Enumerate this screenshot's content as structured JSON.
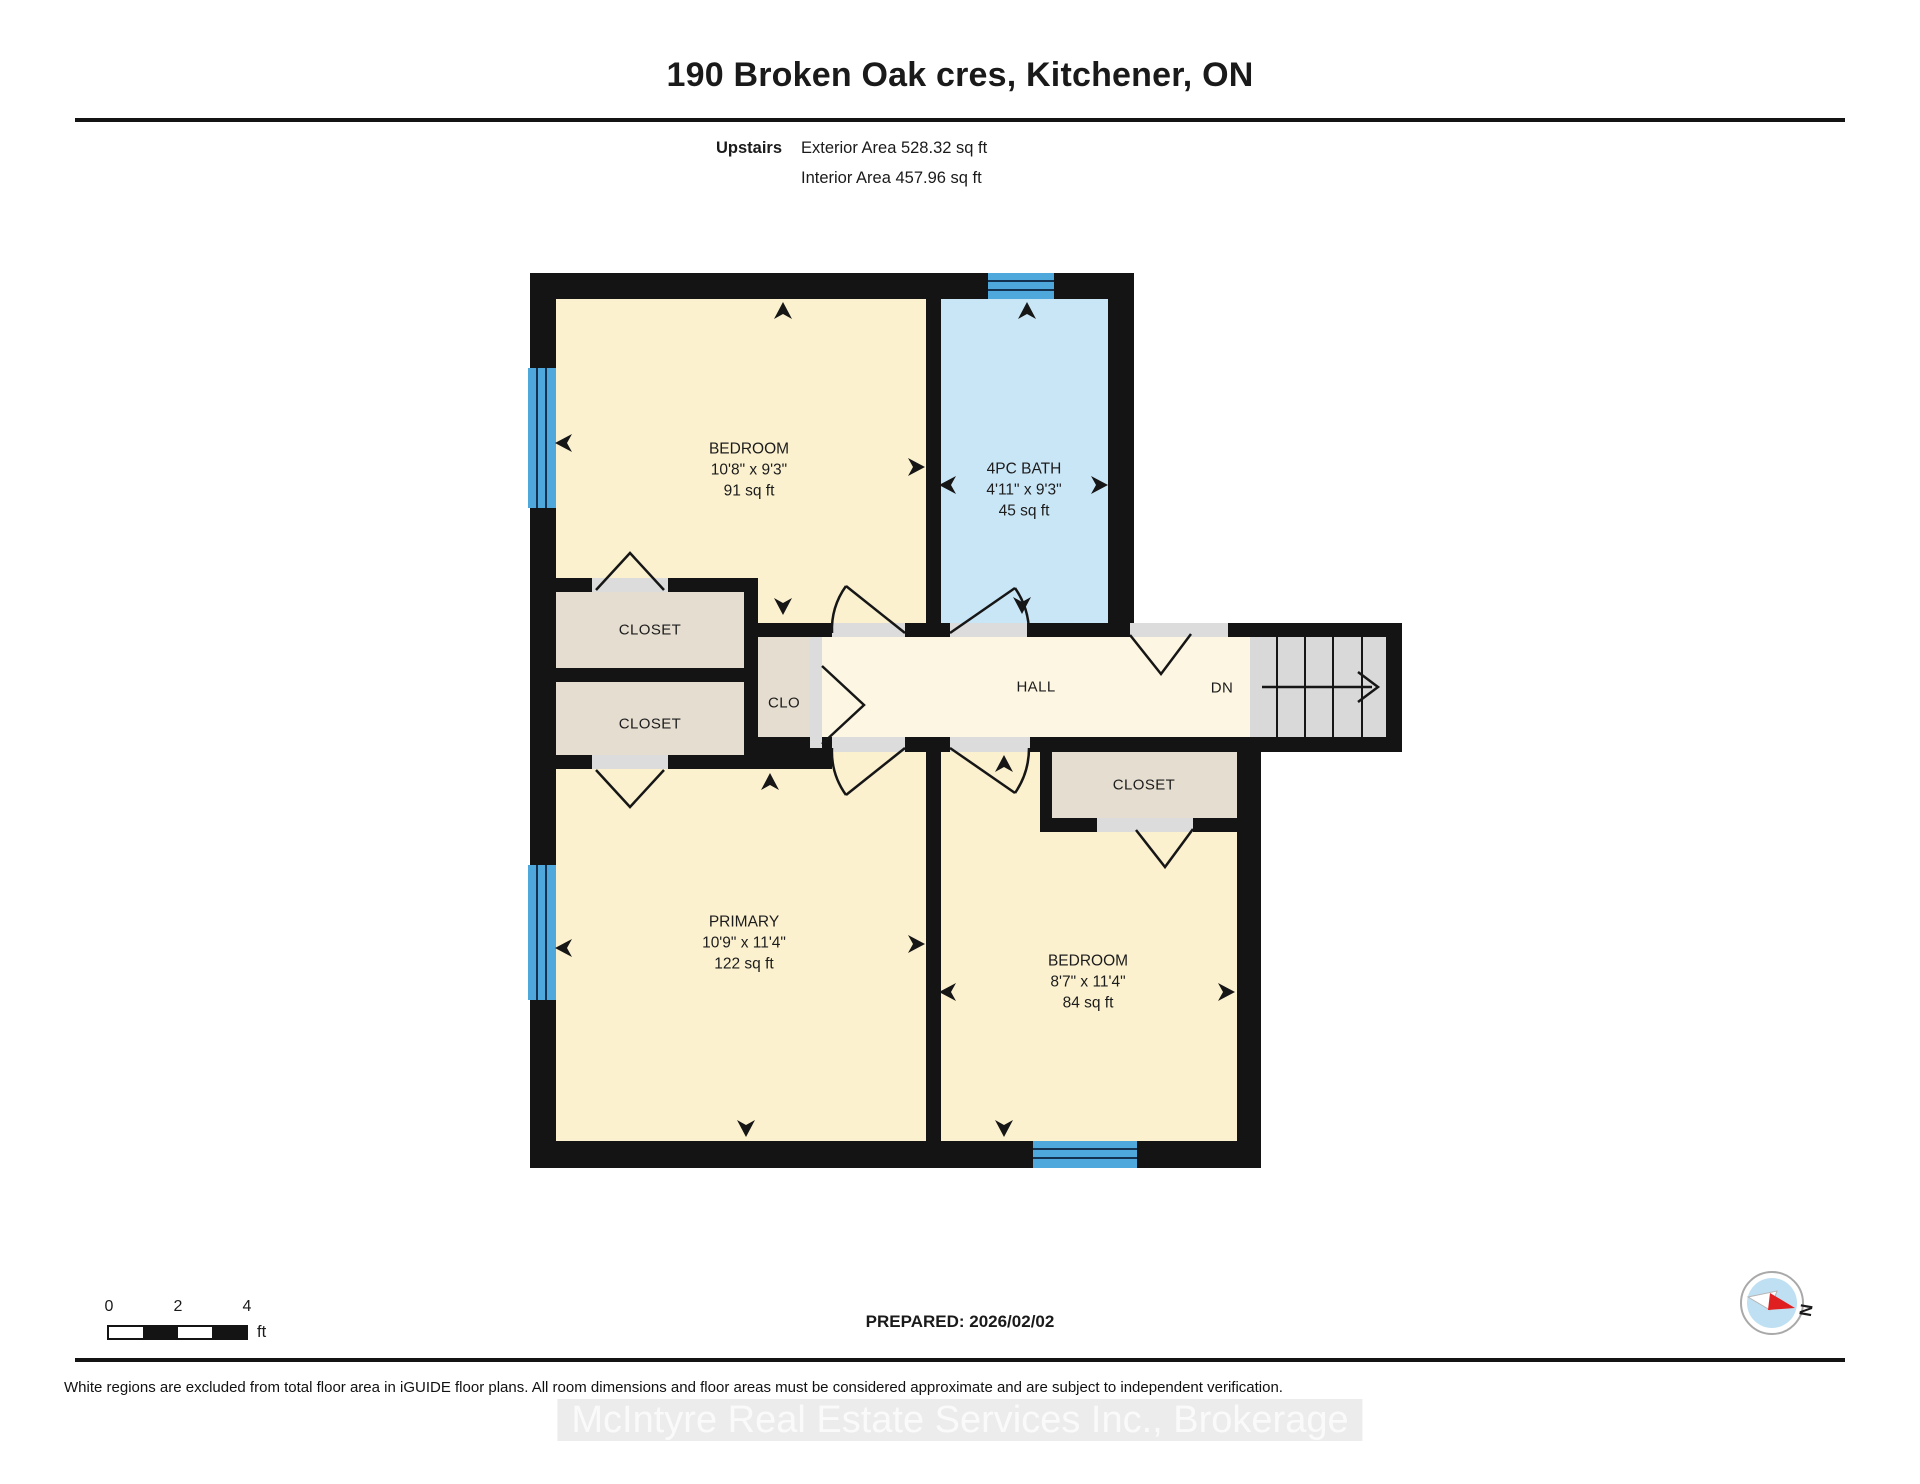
{
  "header": {
    "title": "190 Broken Oak cres, Kitchener, ON",
    "floor_label": "Upstairs",
    "exterior_area": "Exterior Area 528.32 sq ft",
    "interior_area": "Interior Area 457.96 sq ft"
  },
  "rooms": {
    "bedroom1": {
      "name": "BEDROOM",
      "dims": "10'8\" x 9'3\"",
      "area": "91 sq ft"
    },
    "bath": {
      "name": "4PC BATH",
      "dims": "4'11\" x 9'3\"",
      "area": "45 sq ft"
    },
    "closet_upper": {
      "name": "CLOSET"
    },
    "closet_lower": {
      "name": "CLOSET"
    },
    "clo": {
      "name": "CLO"
    },
    "hall": {
      "name": "HALL"
    },
    "stairs": {
      "dn_label": "DN"
    },
    "closet_bedroom2": {
      "name": "CLOSET"
    },
    "primary": {
      "name": "PRIMARY",
      "dims": "10'9\" x 11'4\"",
      "area": "122 sq ft"
    },
    "bedroom2": {
      "name": "BEDROOM",
      "dims": "8'7\" x 11'4\"",
      "area": "84 sq ft"
    }
  },
  "scale_bar": {
    "tick_0": "0",
    "tick_2": "2",
    "tick_4": "4",
    "unit": "ft"
  },
  "footer": {
    "prepared": "PREPARED: 2026/02/02",
    "compass_label": "N",
    "disclaimer": "White regions are excluded from total floor area in iGUIDE floor plans. All room dimensions and floor areas must be considered approximate and are subject to independent verification.",
    "watermark": "McIntyre Real Estate Services Inc., Brokerage"
  },
  "colors": {
    "wall": "#141414",
    "room_fill": "#FBF1CF",
    "hall_fill": "#FDF6E2",
    "bath_fill": "#C9E6F7",
    "closet_fill": "#E5DDD0",
    "stairs_fill": "#D9D9D9",
    "door_strip": "#DCDCDC",
    "window_blue": "#4FA8DC",
    "accent_red": "#E02020"
  }
}
